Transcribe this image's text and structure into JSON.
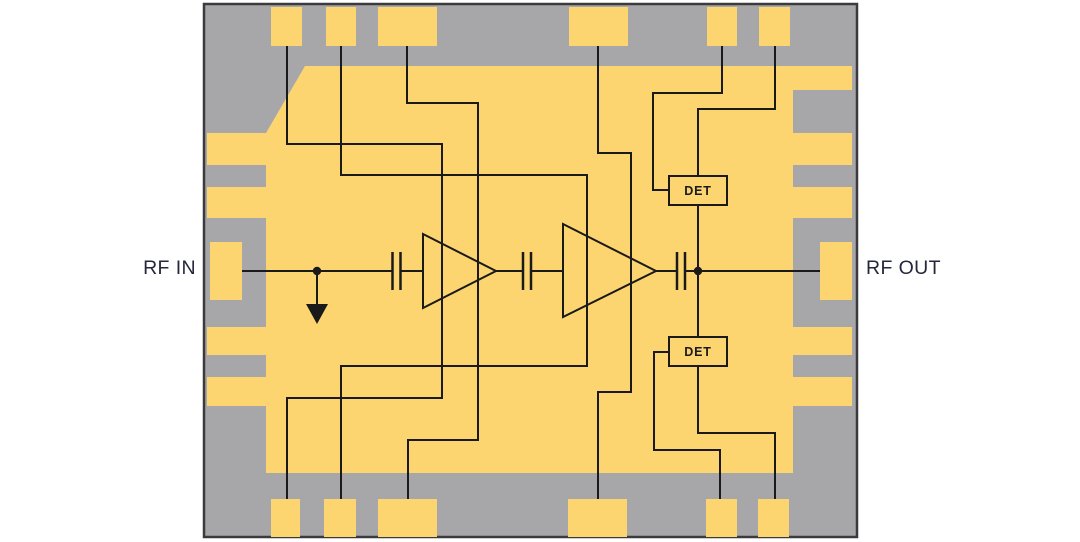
{
  "page": {
    "background_color": "#ffffff"
  },
  "chip": {
    "body_color": "#a7a7a9",
    "outline_color": "#3b3b3d",
    "metal_color": "#fcd570",
    "wire_color": "#1a1a1a"
  },
  "labels": {
    "rf_in": "RF IN",
    "rf_out": "RF OUT",
    "det_upper": "DET",
    "det_lower": "DET",
    "text_color": "#26263c"
  },
  "structure": {
    "amplifier_stages": 2,
    "series_capacitors": 3,
    "power_detectors": 2,
    "top_pads": 6,
    "bottom_pads": 6,
    "left_edge_pads": 4,
    "right_edge_pads": 4,
    "ground_symbols": 1
  }
}
